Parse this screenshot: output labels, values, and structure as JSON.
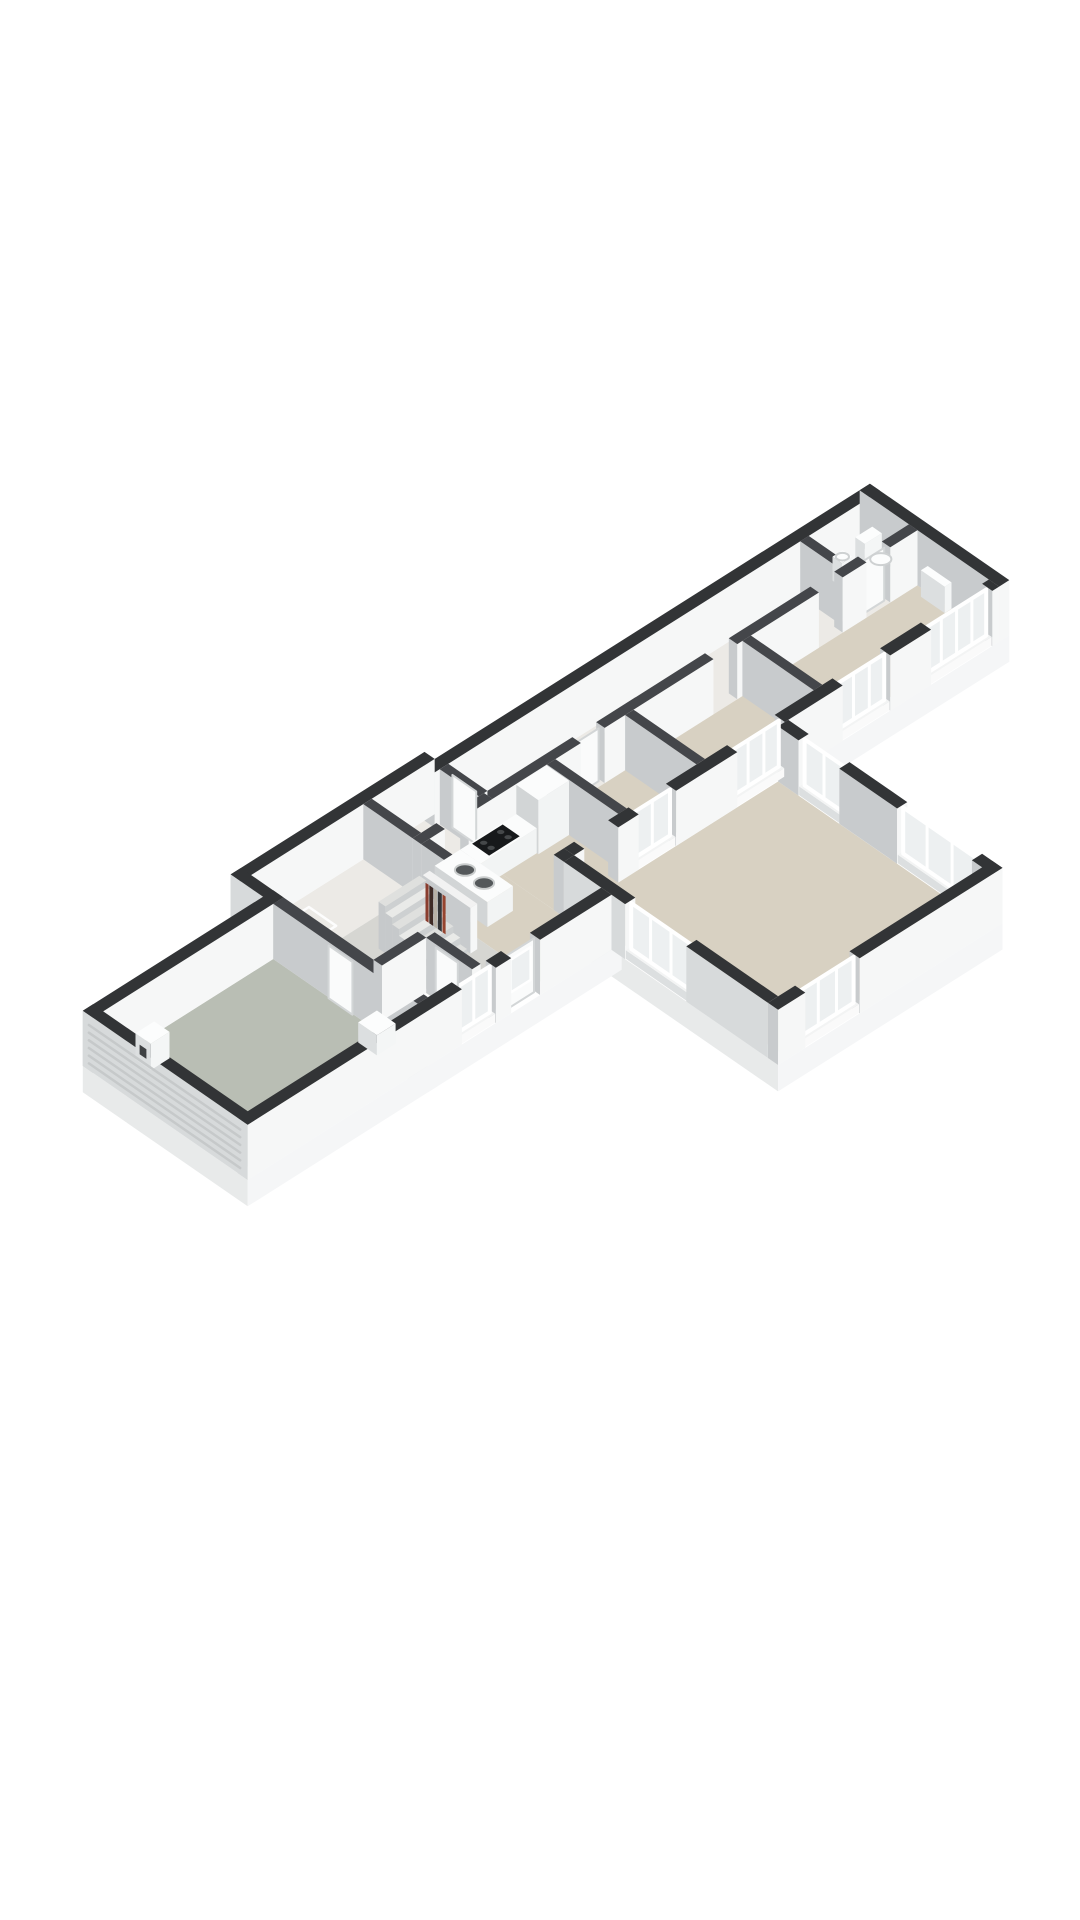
{
  "meta": {
    "alt": "Isometric 3D floor plan render of a single-storey house, cutaway walls, no text labels"
  },
  "scene": {
    "projection": {
      "A": 34,
      "B1": 21.5,
      "B2": 23.5,
      "H": 48,
      "center": [
        546,
        845
      ]
    },
    "colors": {
      "pageBackground": "#ffffff",
      "wallTopExt": "#323436",
      "wallTopInt": "#44464a",
      "faceRight": "#f6f7f7",
      "faceLeft": "#c8cbcd",
      "faceLeftExt": "#d7dadb",
      "floorBeige": "#d8d1c2",
      "floorLight": "#eceae6",
      "floorHall": "#d6d6d2",
      "floorWc": "#e7e7e3",
      "floorGarage": "#b9beb4",
      "slabLeft": "#e8eaea",
      "slabRight": "#f5f6f7",
      "glass": "#edf0f1",
      "frame": "#ffffff",
      "stairTopA": "#e9eae8",
      "stairTopB": "#dfe0de",
      "stairRiser": "#cdd0d1",
      "stairSide": "#c6c9cb",
      "counterTop": "#fbfcfc",
      "counterLeft": "#d2d5d6",
      "counterRight": "#f2f4f4",
      "sinkBowl": "#54585a",
      "sinkRim": "#c9cccc",
      "cooktop": "#17191b",
      "burner": "#45484a",
      "fixtureTop": "#fcfdfd",
      "fixtureLeft": "#dcdfe0",
      "fixtureRight": "#f4f6f6",
      "bowlStroke": "#ced1d2",
      "doorLeaf": "#fafbfb",
      "doorStroke": "#d3d6d7",
      "hatchStroke": "#fdfdfd",
      "slat": "#c6c9ca",
      "boilerHole": "#3f4244",
      "books": [
        "#8a3d2e",
        "#3f2b26",
        "#b8b1a6",
        "#343538",
        "#96442f"
      ]
    },
    "rooms": [
      {
        "id": "garage",
        "floor": "floorGarage"
      },
      {
        "id": "hall",
        "floor": "floorHall"
      },
      {
        "id": "wc",
        "floor": "floorWc"
      },
      {
        "id": "kitchen",
        "floor": "floorBeige"
      },
      {
        "id": "living-room",
        "floor": "floorBeige"
      },
      {
        "id": "bedroom-1",
        "floor": "floorBeige"
      },
      {
        "id": "bedroom-2",
        "floor": "floorBeige"
      },
      {
        "id": "bedroom-3",
        "floor": "floorBeige"
      },
      {
        "id": "bathroom",
        "floor": "floorLight"
      },
      {
        "id": "wing-hallway",
        "floor": "floorLight"
      }
    ],
    "wallHeight": 1.15,
    "elements": [
      {
        "id": "slab-central",
        "k": "slab",
        "r": [
          5.3,
          -0.6,
          11.0,
          5.2
        ]
      },
      {
        "id": "slab-wing",
        "k": "slab",
        "r": [
          10.7,
          -0.3,
          23.8,
          3.8
        ]
      },
      {
        "id": "slab-garage",
        "k": "slab",
        "r": [
          0,
          0.35,
          5.6,
          5.2
        ]
      },
      {
        "id": "slab-living",
        "k": "slab",
        "r": [
          10.7,
          3.8,
          17.3,
          10.1
        ]
      },
      {
        "id": "floor-wing-hallway",
        "k": "floor",
        "r": [
          11.0,
          0,
          23.5,
          1.4
        ],
        "c": "floorLight"
      },
      {
        "id": "floor-bedrooms",
        "k": "floor",
        "r": [
          12.85,
          1.4,
          23.5,
          3.5
        ],
        "c": "floorBeige"
      },
      {
        "id": "floor-central-back",
        "k": "floor",
        "r": [
          5.6,
          -0.3,
          11.0,
          1.15
        ],
        "c": "floorLight"
      },
      {
        "id": "floor-kitchen",
        "k": "floor",
        "r": [
          8.9,
          1.15,
          10.7,
          4.9
        ],
        "c": "floorBeige"
      },
      {
        "id": "floor-kitchen-2",
        "k": "floor",
        "r": [
          10.7,
          1.4,
          12.85,
          3.8
        ],
        "c": "floorBeige"
      },
      {
        "id": "floor-hall",
        "k": "floor",
        "r": [
          5.6,
          1.15,
          8.9,
          4.9
        ],
        "c": "floorHall"
      },
      {
        "id": "floor-wc",
        "k": "floor",
        "r": [
          5.6,
          3.55,
          6.9,
          4.9
        ],
        "c": "floorWc"
      },
      {
        "id": "floor-living-room",
        "k": "floor",
        "r": [
          11.0,
          3.8,
          17.0,
          9.8
        ],
        "c": "floorBeige"
      },
      {
        "id": "floor-garage",
        "k": "floor",
        "r": [
          0.3,
          0.65,
          5.3,
          4.9
        ],
        "c": "floorGarage"
      },
      {
        "id": "wall-wing-back",
        "k": "wall",
        "r": [
          10.7,
          -0.3,
          23.8,
          0
        ],
        "ext": true
      },
      {
        "id": "wall-wing-end",
        "k": "wall",
        "r": [
          23.5,
          -0.3,
          23.8,
          3.8
        ],
        "ext": true
      },
      {
        "id": "wall-wing-front-1",
        "k": "wall",
        "r": [
          11.0,
          3.5,
          11.3,
          3.8
        ],
        "ext": true
      },
      {
        "id": "wall-wing-front-2",
        "k": "wall",
        "r": [
          12.3,
          3.5,
          12.9,
          3.8
        ],
        "ext": true
      },
      {
        "id": "window-bedroom-3",
        "k": "win",
        "axis": "u",
        "at": [
          3.5,
          3.8
        ],
        "r": [
          12.9,
          14.0
        ],
        "div": 1
      },
      {
        "id": "wall-wing-front-3",
        "k": "wall",
        "r": [
          14.0,
          3.5,
          15.8,
          3.8
        ],
        "ext": true
      },
      {
        "id": "window-bedroom-2",
        "k": "win",
        "axis": "u",
        "at": [
          3.5,
          3.8
        ],
        "r": [
          15.8,
          17.2
        ],
        "div": 2
      },
      {
        "id": "wall-wing-front-4",
        "k": "wall",
        "r": [
          17.2,
          3.5,
          18.9,
          3.8
        ],
        "ext": true
      },
      {
        "id": "window-bedroom-1a",
        "k": "win",
        "axis": "u",
        "at": [
          3.5,
          3.8
        ],
        "r": [
          18.9,
          20.3
        ],
        "div": 2
      },
      {
        "id": "wall-wing-front-5",
        "k": "wall",
        "r": [
          20.3,
          3.5,
          21.5,
          3.8
        ],
        "ext": true
      },
      {
        "id": "window-bedroom-1b",
        "k": "win",
        "axis": "u",
        "at": [
          3.5,
          3.8
        ],
        "r": [
          21.5,
          23.3
        ],
        "div": 3
      },
      {
        "id": "wall-wing-front-6",
        "k": "wall",
        "r": [
          23.3,
          3.5,
          23.5,
          3.8
        ],
        "ext": true
      },
      {
        "id": "wall-central-back",
        "k": "wall",
        "r": [
          5.3,
          -0.6,
          11.0,
          -0.3
        ],
        "ext": true
      },
      {
        "id": "wall-central-left",
        "k": "wall",
        "r": [
          5.3,
          -0.6,
          5.6,
          0.65
        ],
        "ext": true,
        "lext": true
      },
      {
        "id": "wall-garage-back",
        "k": "wall",
        "r": [
          0,
          0.35,
          5.6,
          0.65
        ],
        "ext": true
      },
      {
        "id": "wall-garage-end",
        "k": "wall",
        "r": [
          0,
          0.35,
          0.3,
          5.2
        ],
        "ext": true,
        "lext": true
      },
      {
        "id": "garage-door-slats",
        "k": "slats",
        "at": 0,
        "vr": [
          0.55,
          5.0
        ],
        "n": 6
      },
      {
        "id": "wall-front-1",
        "k": "wall",
        "r": [
          0,
          4.9,
          6.3,
          5.2
        ],
        "ext": true
      },
      {
        "id": "window-hall-front",
        "k": "win",
        "axis": "u",
        "at": [
          4.9,
          5.2
        ],
        "r": [
          6.3,
          7.3
        ],
        "div": 1
      },
      {
        "id": "wall-front-2",
        "k": "wall",
        "r": [
          7.3,
          4.9,
          7.75,
          5.2
        ],
        "ext": true
      },
      {
        "id": "entry-door",
        "k": "door",
        "axis": "u",
        "at": 5.05,
        "r": [
          7.78,
          8.57
        ],
        "h": 1.12,
        "glass": true
      },
      {
        "id": "wall-front-3",
        "k": "wall",
        "r": [
          8.6,
          4.9,
          10.7,
          5.2
        ],
        "ext": true
      },
      {
        "id": "wall-living-left-1",
        "k": "wall",
        "r": [
          10.7,
          3.8,
          11.0,
          5.6
        ],
        "ext": true,
        "lext": true
      },
      {
        "id": "window-pass-through",
        "k": "win",
        "axis": "v",
        "at": [
          10.7,
          11.0
        ],
        "r": [
          5.6,
          7.4
        ],
        "div": 2
      },
      {
        "id": "wall-living-left-2",
        "k": "wall",
        "r": [
          10.7,
          7.4,
          11.0,
          9.8
        ],
        "ext": true,
        "lext": true
      },
      {
        "id": "wall-corner",
        "k": "wall",
        "r": [
          10.7,
          3.5,
          11.0,
          3.8
        ],
        "ext": true
      },
      {
        "id": "wall-living-front-1",
        "k": "wall",
        "r": [
          10.7,
          9.8,
          11.5,
          10.1
        ],
        "ext": true
      },
      {
        "id": "window-living-front",
        "k": "win",
        "axis": "u",
        "at": [
          9.8,
          10.1
        ],
        "r": [
          11.5,
          13.1
        ],
        "div": 2
      },
      {
        "id": "wall-living-front-2",
        "k": "wall",
        "r": [
          13.1,
          9.8,
          17.3,
          10.1
        ],
        "ext": true
      },
      {
        "id": "wall-living-right-1",
        "k": "wall",
        "r": [
          17.0,
          3.8,
          17.3,
          4.4
        ],
        "ext": true
      },
      {
        "id": "window-living-1",
        "k": "win",
        "axis": "v",
        "at": [
          17.0,
          17.3
        ],
        "r": [
          4.4,
          5.6
        ],
        "div": 1
      },
      {
        "id": "wall-living-right-2",
        "k": "wall",
        "r": [
          17.0,
          5.6,
          17.3,
          7.3
        ],
        "ext": true
      },
      {
        "id": "window-living-2",
        "k": "win",
        "axis": "v",
        "at": [
          17.0,
          17.3
        ],
        "r": [
          7.3,
          9.5
        ],
        "div": 2
      },
      {
        "id": "wall-living-right-3",
        "k": "wall",
        "r": [
          17.0,
          9.5,
          17.3,
          10.1
        ],
        "ext": true
      },
      {
        "id": "wall-hallway-1",
        "k": "wall",
        "r": [
          11.0,
          1.15,
          13.6,
          1.4
        ]
      },
      {
        "id": "door-bedroom-3",
        "k": "door",
        "axis": "u",
        "at": 1.27,
        "r": [
          13.65,
          14.25
        ],
        "h": 1.1
      },
      {
        "id": "wall-hallway-2",
        "k": "wall",
        "r": [
          14.3,
          1.15,
          17.5,
          1.4
        ]
      },
      {
        "id": "wall-hallway-3",
        "k": "wall",
        "r": [
          18.2,
          1.15,
          20.6,
          1.4
        ]
      },
      {
        "id": "wall-hallway-4",
        "k": "wall",
        "r": [
          21.3,
          1.15,
          22.0,
          1.4
        ]
      },
      {
        "id": "door-bathroom",
        "k": "door",
        "axis": "u",
        "at": 1.27,
        "r": [
          22.05,
          22.65
        ],
        "h": 1.1
      },
      {
        "id": "wall-hallway-5",
        "k": "wall",
        "r": [
          22.7,
          1.15,
          23.5,
          1.4
        ]
      },
      {
        "id": "wall-bathroom-divider",
        "k": "wall",
        "r": [
          21.45,
          0,
          21.7,
          1.15
        ]
      },
      {
        "id": "wall-bedroom-divider-1",
        "k": "wall",
        "r": [
          14.9,
          1.4,
          15.15,
          3.5
        ]
      },
      {
        "id": "wall-bedroom-divider-2",
        "k": "wall",
        "r": [
          18.35,
          1.4,
          18.6,
          3.5
        ]
      },
      {
        "id": "wall-kitchen-right",
        "k": "wall",
        "r": [
          12.6,
          1.4,
          12.85,
          3.5
        ]
      },
      {
        "id": "wall-kitchen-back-1",
        "k": "wall",
        "r": [
          8.9,
          1.15,
          9.6,
          1.4
        ]
      },
      {
        "id": "wall-kitchen-back-2",
        "k": "wall",
        "r": [
          10.3,
          1.15,
          11.0,
          1.4
        ]
      },
      {
        "id": "wall-central-divider",
        "k": "wall",
        "r": [
          8.9,
          -0.3,
          9.15,
          1.15
        ]
      },
      {
        "id": "wall-wing-start",
        "k": "wall",
        "r": [
          10.85,
          0,
          11.1,
          1.15
        ]
      },
      {
        "id": "door-wing-hallway",
        "k": "door",
        "axis": "v",
        "at": 10.97,
        "r": [
          0.25,
          0.95
        ],
        "h": 1.1,
        "dz": 0.8
      },
      {
        "id": "wall-garage-right",
        "k": "wall",
        "r": [
          5.3,
          0.65,
          5.6,
          4.9
        ]
      },
      {
        "id": "door-garage",
        "k": "door",
        "axis": "v",
        "at": 5.28,
        "r": [
          2.3,
          3.0
        ],
        "h": 1.1,
        "dz": 0.8
      },
      {
        "id": "wall-wc-back",
        "k": "wall",
        "r": [
          5.6,
          3.3,
          6.9,
          3.55
        ]
      },
      {
        "id": "wall-wc-right",
        "k": "wall",
        "r": [
          6.9,
          3.55,
          7.15,
          4.9
        ]
      },
      {
        "id": "door-wc",
        "k": "door",
        "axis": "v",
        "at": 6.88,
        "r": [
          3.85,
          4.5
        ],
        "h": 1.1,
        "dz": 0.8
      },
      {
        "id": "wall-hall-stub",
        "k": "wall",
        "r": [
          8.9,
          1.4,
          9.15,
          2.6
        ]
      },
      {
        "id": "stairs",
        "k": "stairs",
        "r": [
          7.15,
          1.9,
          8.35,
          3.3
        ],
        "n": 7,
        "dz": 1
      },
      {
        "id": "bookshelf",
        "k": "box",
        "r": [
          8.45,
          1.9,
          8.65,
          3.3
        ],
        "h": 0.95,
        "dz": 1
      },
      {
        "id": "bookshelf-books",
        "k": "books",
        "at": 8.43,
        "vr": [
          2.0,
          2.6
        ],
        "dz": 2
      },
      {
        "id": "kitchen-counter-sink",
        "k": "box",
        "r": [
          9.3,
          1.4,
          10.05,
          2.95
        ],
        "h": 0.52,
        "counter": true,
        "dz": 1
      },
      {
        "id": "sink-bowl-1",
        "k": "disc",
        "c": [
          9.67,
          1.92
        ],
        "h": 0.52,
        "rad": 0.23,
        "fill": "sinkBowl",
        "stroke": "sinkRim",
        "dz": 2
      },
      {
        "id": "sink-bowl-2",
        "k": "disc",
        "c": [
          9.67,
          2.48
        ],
        "h": 0.52,
        "rad": 0.23,
        "fill": "sinkBowl",
        "stroke": "sinkRim",
        "dz": 2
      },
      {
        "id": "kitchen-cabinet-tall",
        "k": "box",
        "r": [
          11.7,
          1.4,
          12.6,
          2.05
        ],
        "h": 1.13,
        "counter": true,
        "dz": 1
      },
      {
        "id": "kitchen-counter-main",
        "k": "box",
        "r": [
          10.05,
          1.4,
          11.7,
          2.0
        ],
        "h": 0.52,
        "counter": true,
        "dz": 1.2
      },
      {
        "id": "cooktop",
        "k": "cook",
        "r": [
          10.35,
          1.45,
          11.25,
          1.95
        ],
        "h": 0.53,
        "dz": 2
      },
      {
        "id": "toilet-cistern",
        "k": "box",
        "r": [
          22.95,
          0.12,
          23.45,
          0.4
        ],
        "h": 0.62,
        "fixture": true,
        "dz": 1
      },
      {
        "id": "toilet-bowl",
        "k": "disc",
        "c": [
          23.2,
          0.62
        ],
        "h": 0.3,
        "rad": 0.24,
        "fill": "fixtureTop",
        "stroke": "bowlStroke",
        "dz": 1.5
      },
      {
        "id": "washbasin",
        "k": "box",
        "r": [
          22.3,
          0.1,
          22.6,
          0.38
        ],
        "h": 0.5,
        "fixture": true,
        "dz": 1
      },
      {
        "id": "washbasin-bowl",
        "k": "disc",
        "c": [
          22.45,
          0.24
        ],
        "h": 0.5,
        "rad": 0.15,
        "fill": "fixtureTop",
        "stroke": "bowlStroke",
        "dz": 1.5
      },
      {
        "id": "radiator-bedroom-1",
        "k": "box",
        "r": [
          23.3,
          1.7,
          23.5,
          2.4
        ],
        "h": 0.55,
        "fixture": true,
        "dz": 1
      },
      {
        "id": "boiler",
        "k": "box",
        "r": [
          0.95,
          0.95,
          1.5,
          1.4
        ],
        "h": 0.55,
        "fixture": true,
        "dz": 1
      },
      {
        "id": "boiler-vent",
        "k": "hole",
        "at": 0.95,
        "vr": [
          1.08,
          1.28
        ],
        "hr": [
          0.18,
          0.38
        ],
        "dz": 2
      },
      {
        "id": "garage-sink",
        "k": "box",
        "r": [
          4.75,
          3.7,
          5.3,
          4.25
        ],
        "h": 0.42,
        "fixture": true,
        "dz": 1
      },
      {
        "id": "floor-hatch-1",
        "k": "hatch",
        "c": [
          13.3,
          0.6
        ],
        "s": 0.45,
        "dz": 0.5
      },
      {
        "id": "floor-hatch-2",
        "k": "hatch",
        "c": [
          15.9,
          0.6
        ],
        "s": 0.45,
        "dz": 0.5
      },
      {
        "id": "floor-hatch-3",
        "k": "hatch",
        "c": [
          9.9,
          0.45
        ],
        "s": 0.4,
        "dz": 0.5
      },
      {
        "id": "floor-hatch-4",
        "k": "hatch",
        "c": [
          6.6,
          0.4
        ],
        "s": 0.4,
        "dz": 0.5
      },
      {
        "id": "floor-hatch-5",
        "k": "hatch",
        "c": [
          7.35,
          4.0
        ],
        "s": 0.5,
        "dz": 0.5
      }
    ]
  }
}
